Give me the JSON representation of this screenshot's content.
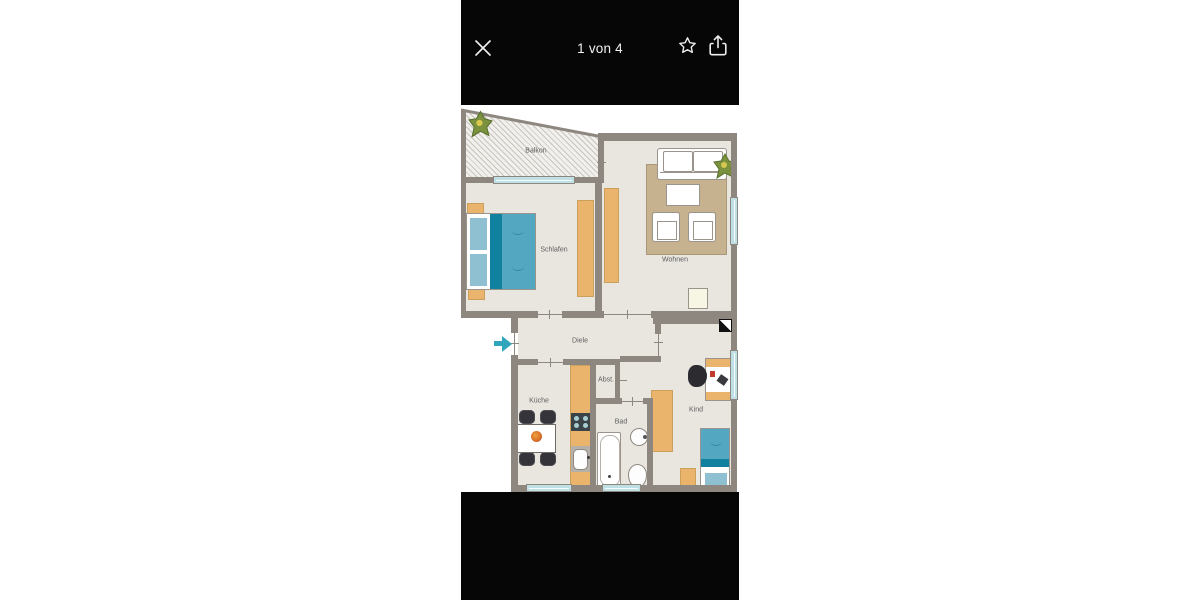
{
  "viewer": {
    "counter": "1 von 4",
    "icons": {
      "close": "close-icon",
      "favorite": "star-icon",
      "share": "share-icon"
    }
  },
  "floorplan": {
    "rooms": {
      "balkon": "Balkon",
      "schlafen": "Schlafen",
      "wohnen": "Wohnen",
      "diele": "Diele",
      "kueche": "Küche",
      "abst": "Abst.",
      "bad": "Bad",
      "kind": "Kind"
    },
    "symbols": {
      "entrance_arrow": "entrance-arrow",
      "shaft": "shaft-symbol",
      "plants": [
        "balcony-plant",
        "living-room-plant"
      ]
    }
  },
  "colors": {
    "bar_background": "#060606",
    "bar_foreground": "#f2f2f2",
    "wall": "#8d8780",
    "floor": "#e9e6e0",
    "furniture_wood": "#eab46c",
    "rug": "#c6b28e",
    "bed_teal": "#54a7c0",
    "bed_teal_dark": "#12809f",
    "bed_teal_light": "#8fc0d2",
    "window_glass": "#bfe0e4",
    "entrance_arrow": "#2fa6bc",
    "plant_green": "#7b913e"
  }
}
